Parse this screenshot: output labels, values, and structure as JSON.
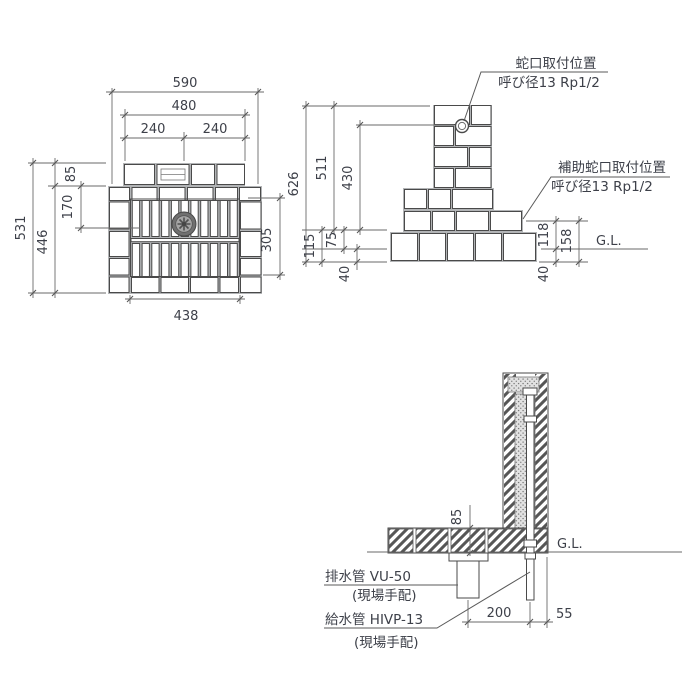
{
  "drawing": {
    "plan": {
      "dims": {
        "overall_width": "590",
        "back_width": "480",
        "half_left": "240",
        "half_right": "240",
        "overall_depth": "531",
        "pan_depth": "446",
        "back_depth": "85",
        "drain_offset": "170",
        "grate_depth": "305",
        "inner_width": "438"
      }
    },
    "elevation": {
      "dims": {
        "overall_height": "626",
        "column_height": "511",
        "faucet_height": "430",
        "base_total": "115",
        "base_above_gl": "75",
        "base_below_gl": "40",
        "aux_height": "118",
        "aux_total": "158",
        "below_gl_right": "40"
      },
      "labels": {
        "faucet_title": "蛇口取付位置",
        "faucet_spec": "呼び径13 Rp1/2",
        "aux_title": "補助蛇口取付位置",
        "aux_spec": "呼び径13 Rp1/2",
        "ground": "G.L."
      }
    },
    "section": {
      "dims": {
        "pan_height": "85",
        "drain_to_supply": "200",
        "supply_to_edge": "55"
      },
      "labels": {
        "drain_name": "排水管  VU-50",
        "drain_note": "(現場手配)",
        "supply_name": "給水管  HIVP-13",
        "supply_note": "(現場手配)",
        "ground": "G.L."
      }
    }
  }
}
